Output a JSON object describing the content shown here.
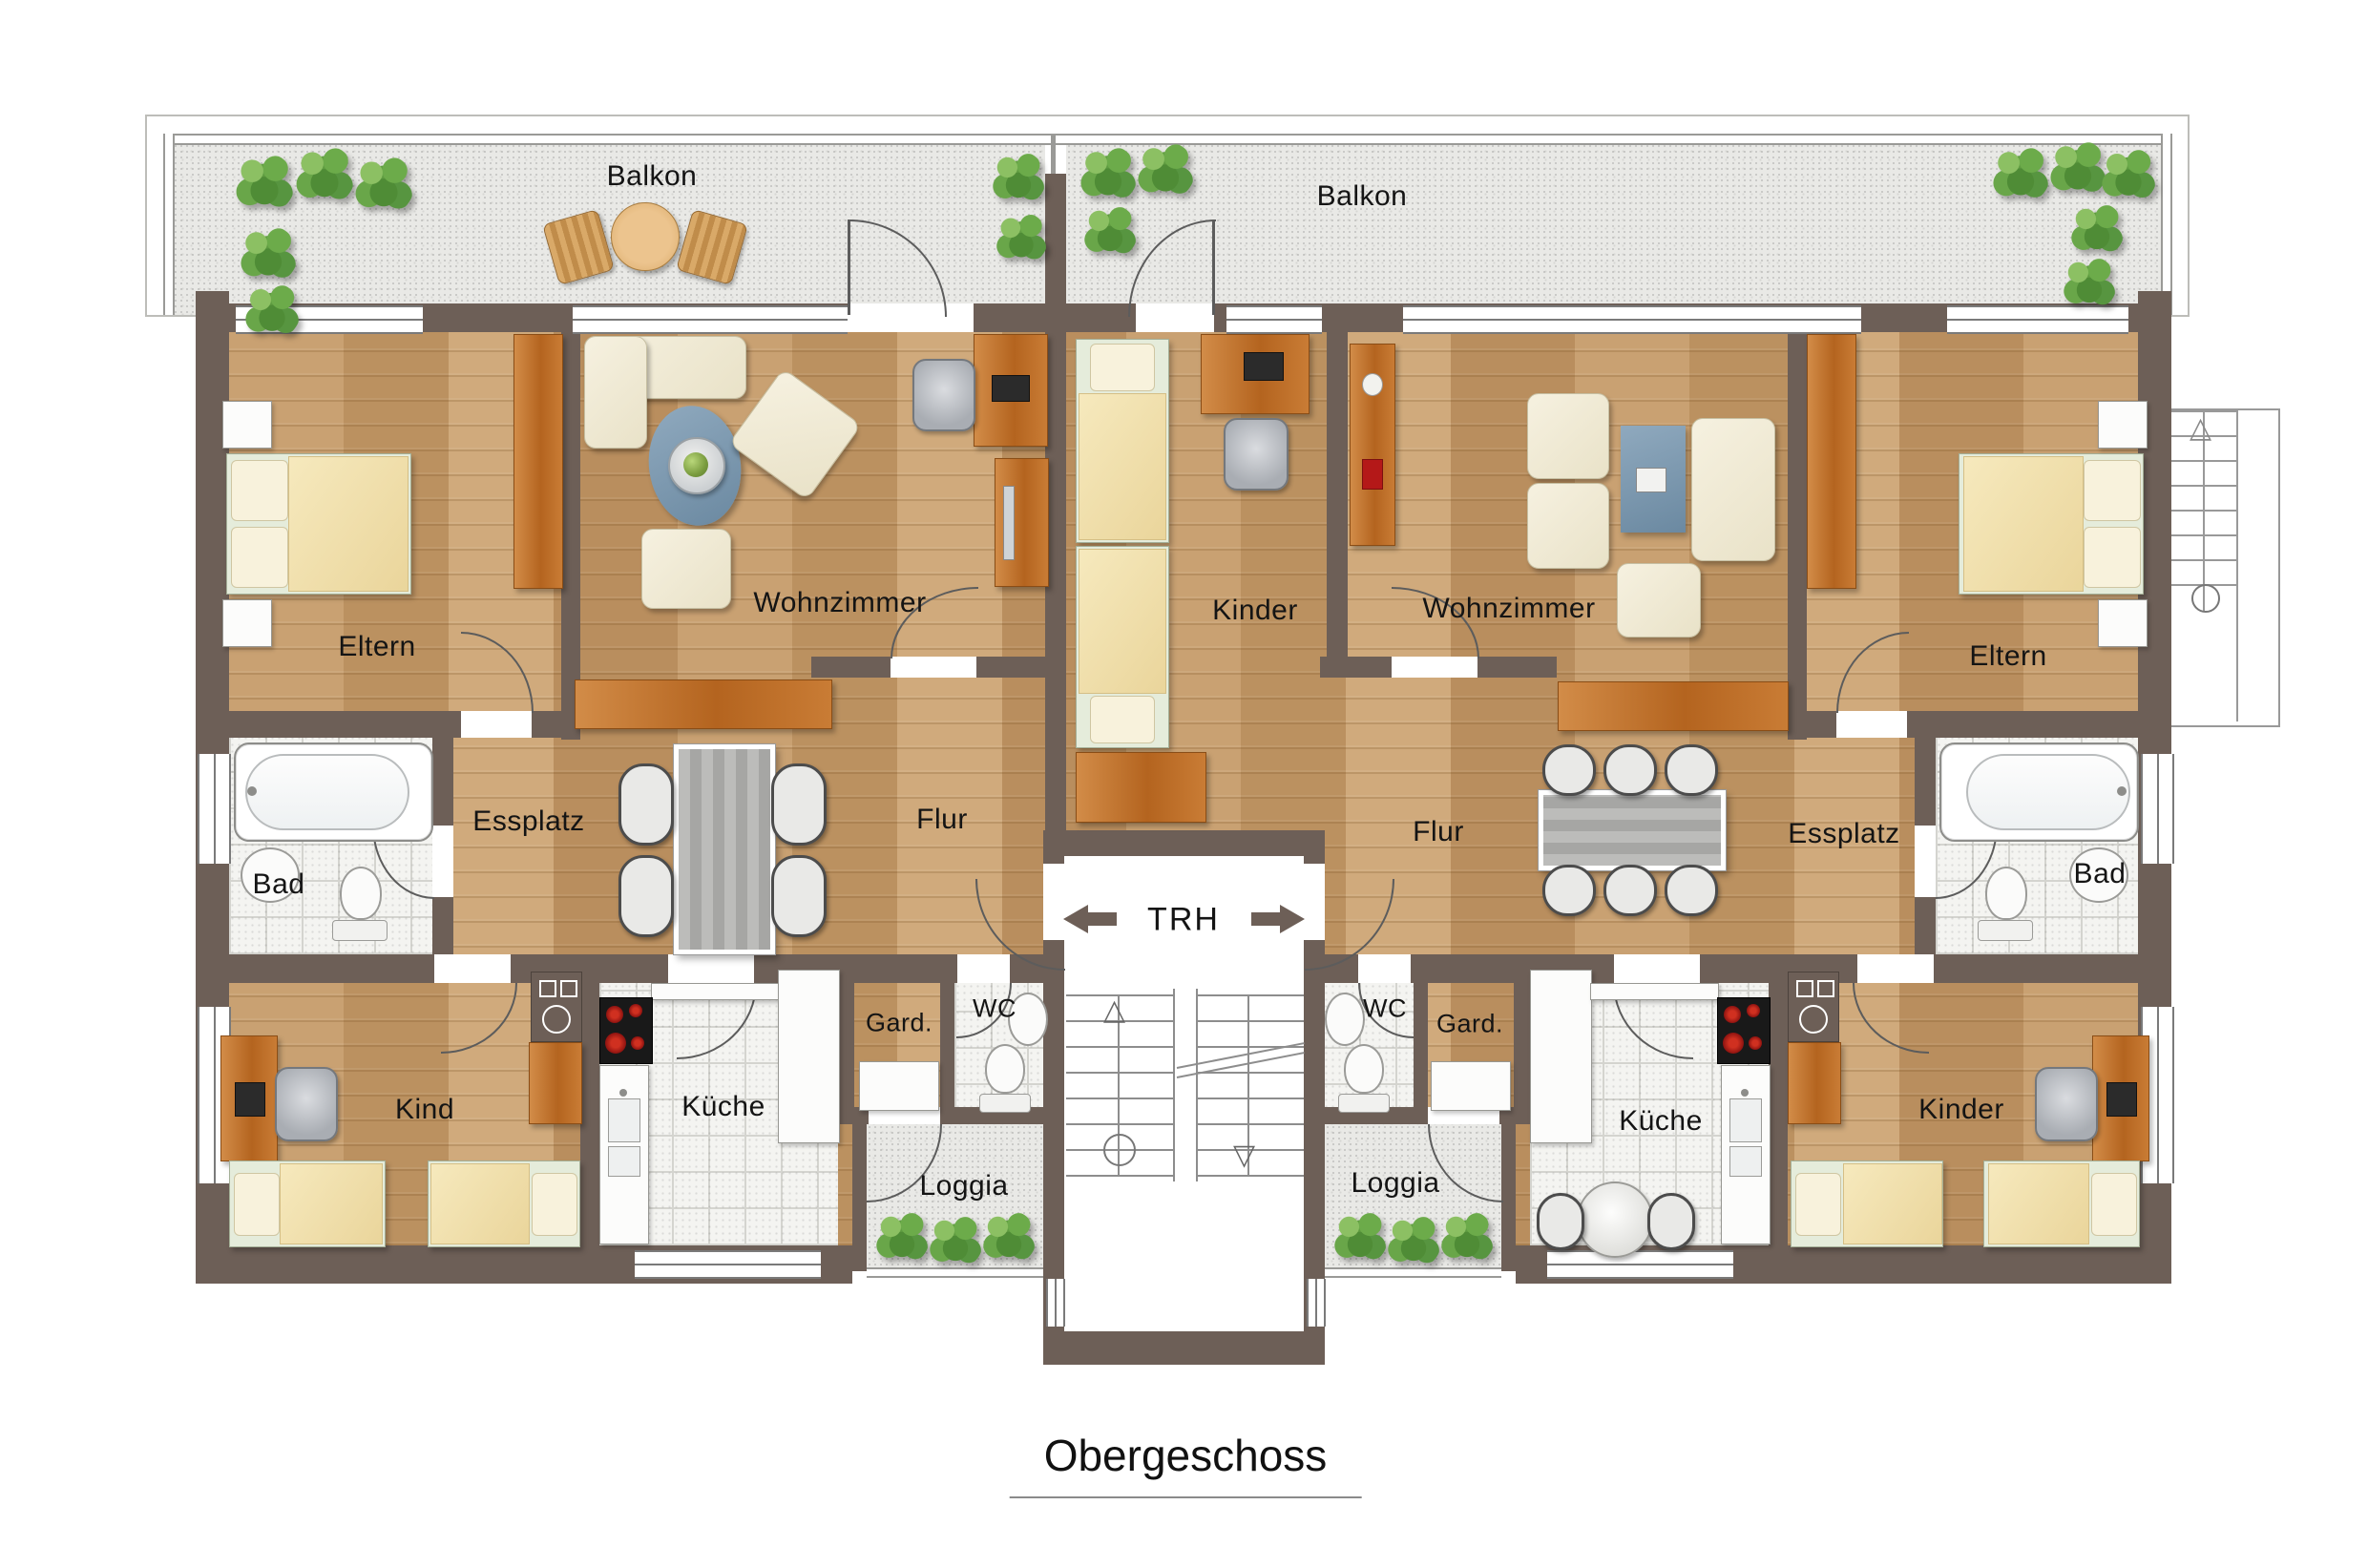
{
  "title": "Obergeschoss",
  "stairwell": {
    "label": "TRH"
  },
  "left": {
    "balkon": "Balkon",
    "eltern": "Eltern",
    "wohnzimmer": "Wohnzimmer",
    "essplatz": "Essplatz",
    "flur": "Flur",
    "bad": "Bad",
    "gard": "Gard.",
    "wc": "WC",
    "kind": "Kind",
    "kueche": "Küche",
    "loggia": "Loggia"
  },
  "right": {
    "balkon": "Balkon",
    "kinder_top": "Kinder",
    "wohnzimmer": "Wohnzimmer",
    "eltern": "Eltern",
    "flur": "Flur",
    "essplatz": "Essplatz",
    "bad": "Bad",
    "wc": "WC",
    "gard": "Gard.",
    "kueche": "Küche",
    "kinder_bottom": "Kinder",
    "loggia": "Loggia"
  },
  "colors": {
    "wall": "#6d5f57",
    "wood_floor": "#c59c6d",
    "tile_floor": "#f4f4f1",
    "exterior_floor": "#e9e9e6",
    "furniture_wood": "#c0762f",
    "upholstery": "#f2edda",
    "rug_blue": "#7b97ad",
    "table_gray": "#aeaeac",
    "plant_green": "#5f9c41",
    "hob_black": "#191919",
    "burner_red": "#8e1310"
  }
}
